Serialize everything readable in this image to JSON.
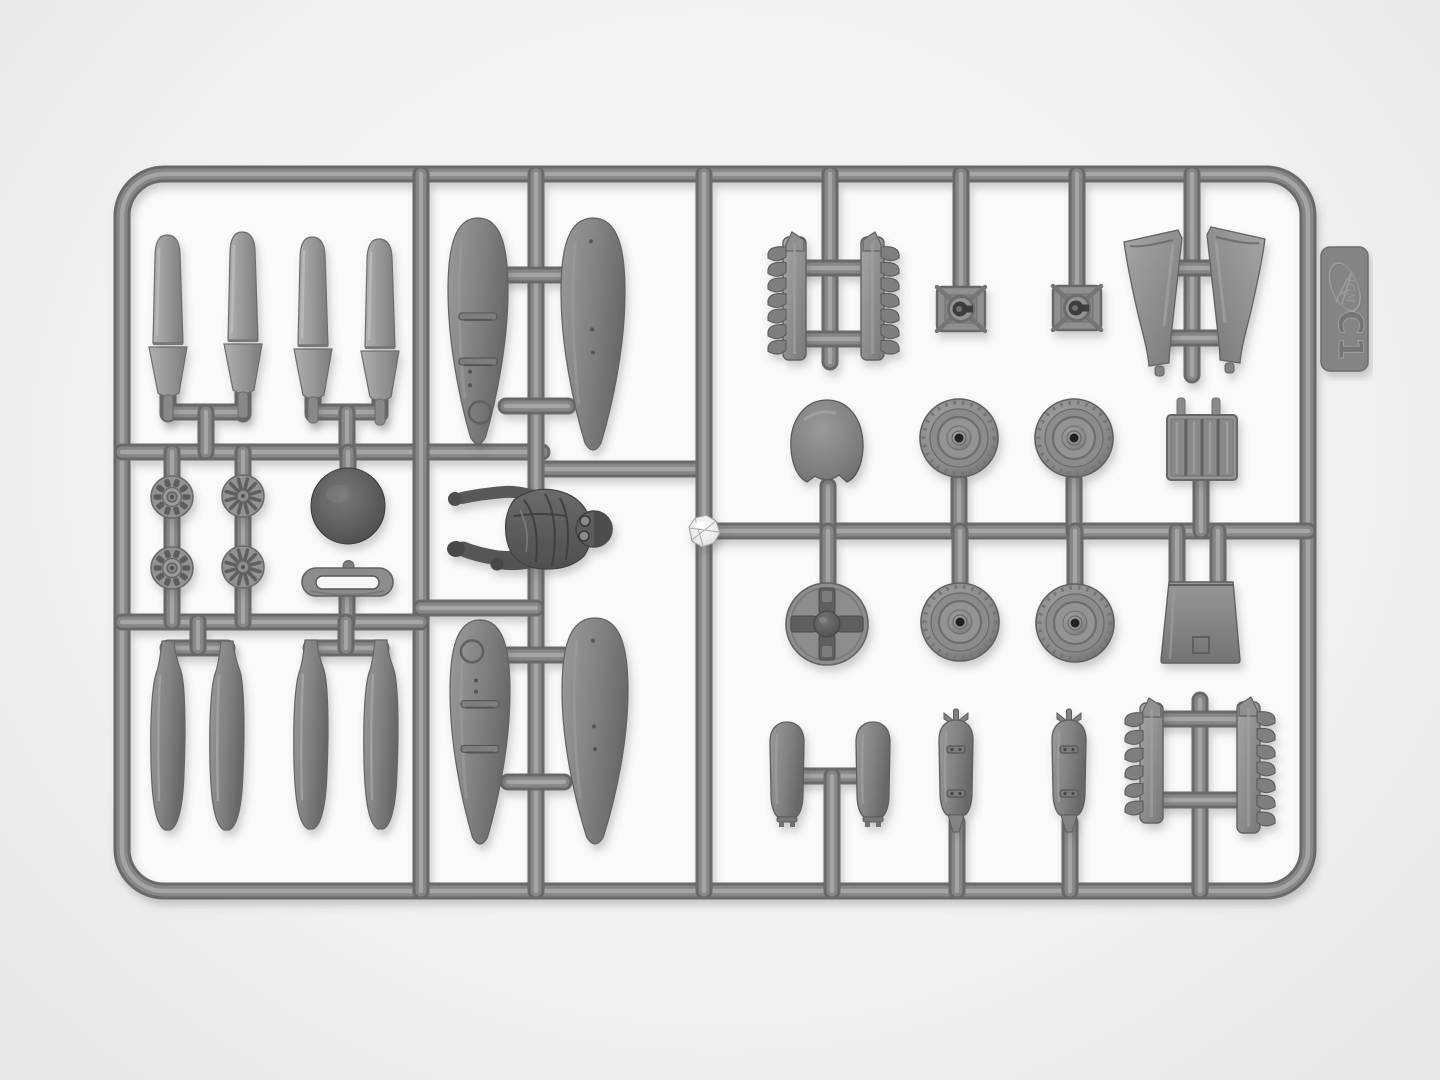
{
  "photo": {
    "description": "Top-down photo of a gray injection-molded model kit parts sprue on a white background",
    "background_color": "#f2f2f2",
    "interior_color": "#fafafa",
    "plastic_color": "#8a8a8a",
    "runner_color": "#6f6f6f"
  },
  "sprue": {
    "brand": "ICM",
    "code": "C1",
    "tab": {
      "x": 1321,
      "y": 247,
      "w": 47,
      "h": 124
    }
  },
  "frame": {
    "x1": 122,
    "y1": 174,
    "x2": 1308,
    "y2": 891,
    "radius": 42
  },
  "runners": [
    [
      122,
      452,
      542,
      452
    ],
    [
      536,
      469,
      704,
      469
    ],
    [
      421,
      174,
      421,
      891
    ],
    [
      536,
      174,
      536,
      891
    ],
    [
      704,
      174,
      704,
      891
    ],
    [
      421,
      608,
      536,
      608
    ],
    [
      122,
      622,
      421,
      622
    ],
    [
      704,
      531,
      1308,
      531
    ],
    [
      506,
      275,
      568,
      275
    ],
    [
      506,
      406,
      568,
      406
    ],
    [
      508,
      655,
      564,
      655
    ],
    [
      508,
      782,
      564,
      782
    ],
    [
      168,
      388,
      168,
      414
    ],
    [
      243,
      388,
      243,
      414
    ],
    [
      168,
      412,
      243,
      412
    ],
    [
      206,
      412,
      206,
      452
    ],
    [
      313,
      388,
      313,
      414
    ],
    [
      380,
      388,
      380,
      414
    ],
    [
      313,
      412,
      380,
      412
    ],
    [
      347,
      412,
      347,
      452
    ],
    [
      172,
      452,
      172,
      480
    ],
    [
      172,
      518,
      172,
      552
    ],
    [
      172,
      588,
      172,
      622
    ],
    [
      243,
      452,
      243,
      480
    ],
    [
      243,
      518,
      243,
      552
    ],
    [
      243,
      588,
      243,
      622
    ],
    [
      348,
      452,
      348,
      475
    ],
    [
      347,
      594,
      347,
      622
    ],
    [
      168,
      648,
      227,
      648
    ],
    [
      198,
      648,
      198,
      622
    ],
    [
      311,
      648,
      381,
      648
    ],
    [
      346,
      648,
      346,
      622
    ],
    [
      830,
      174,
      830,
      362
    ],
    [
      800,
      268,
      868,
      268
    ],
    [
      800,
      339,
      868,
      339
    ],
    [
      961,
      174,
      961,
      295
    ],
    [
      1077,
      174,
      1077,
      295
    ],
    [
      1192,
      174,
      1192,
      375
    ],
    [
      1160,
      268,
      1224,
      268
    ],
    [
      1160,
      338,
      1224,
      338
    ],
    [
      828,
      531,
      828,
      486
    ],
    [
      959,
      531,
      959,
      480
    ],
    [
      1074,
      531,
      1074,
      480
    ],
    [
      1201,
      531,
      1201,
      478
    ],
    [
      1177,
      531,
      1177,
      584
    ],
    [
      1218,
      531,
      1218,
      584
    ],
    [
      828,
      531,
      828,
      586
    ],
    [
      960,
      531,
      960,
      586
    ],
    [
      1075,
      531,
      1075,
      586
    ],
    [
      800,
      776,
      860,
      776
    ],
    [
      832,
      776,
      832,
      891
    ],
    [
      957,
      822,
      957,
      891
    ],
    [
      1070,
      822,
      1070,
      891
    ],
    [
      1200,
      700,
      1200,
      891
    ],
    [
      1158,
      719,
      1240,
      719
    ],
    [
      1158,
      800,
      1240,
      800
    ]
  ],
  "parts": [
    {
      "name": "propeller-blade-1",
      "type": "blade",
      "cx": 168,
      "top": 235
    },
    {
      "name": "propeller-blade-2",
      "type": "blade",
      "cx": 243,
      "top": 232
    },
    {
      "name": "propeller-blade-3",
      "type": "blade",
      "cx": 313,
      "top": 237
    },
    {
      "name": "propeller-blade-4",
      "type": "blade",
      "cx": 380,
      "top": 239
    },
    {
      "name": "float-half-top-outer",
      "type": "float",
      "cx": 478,
      "top": 218,
      "h": 226,
      "w": 60,
      "detail": "A"
    },
    {
      "name": "float-half-top-inner",
      "type": "float",
      "cx": 593,
      "top": 218,
      "h": 232,
      "w": 64,
      "detail": "plain"
    },
    {
      "name": "float-half-bottom-outer",
      "type": "float",
      "cx": 480,
      "top": 620,
      "h": 224,
      "w": 60,
      "detail": "B"
    },
    {
      "name": "float-half-bottom-inner",
      "type": "float",
      "cx": 595,
      "top": 618,
      "h": 226,
      "w": 66,
      "detail": "plain"
    },
    {
      "name": "engine-front-1",
      "type": "engine",
      "cx": 172,
      "cy": 497,
      "variant": "a"
    },
    {
      "name": "engine-front-2",
      "type": "engine",
      "cx": 172,
      "cy": 568,
      "variant": "a"
    },
    {
      "name": "engine-front-3",
      "type": "engine",
      "cx": 243,
      "cy": 496,
      "variant": "b"
    },
    {
      "name": "engine-front-4",
      "type": "engine",
      "cx": 243,
      "cy": 567,
      "variant": "b"
    },
    {
      "name": "spinner-dome",
      "type": "darkdome",
      "cx": 348,
      "cy": 506,
      "r": 37
    },
    {
      "name": "handle-loop",
      "type": "loop",
      "x": 302,
      "y": 568,
      "w": 91,
      "h": 28
    },
    {
      "name": "pilot-figure",
      "type": "pilot"
    },
    {
      "name": "shiny-sprue-gate",
      "type": "shiny",
      "cx": 704,
      "cy": 531
    },
    {
      "name": "exhaust-stack-top-left",
      "type": "exhaust",
      "x": 783,
      "top": 237,
      "h": 123,
      "n": 7,
      "dir": -1
    },
    {
      "name": "exhaust-stack-top-right",
      "type": "exhaust",
      "x": 861,
      "top": 237,
      "h": 123,
      "n": 7,
      "dir": 1
    },
    {
      "name": "mount-square-1",
      "type": "mount",
      "cx": 961,
      "cy": 309
    },
    {
      "name": "mount-square-2",
      "type": "mount",
      "cx": 1077,
      "cy": 308
    },
    {
      "name": "intake-scoop-left",
      "type": "funnel",
      "cx": 1153,
      "top": 230,
      "dir": -1
    },
    {
      "name": "intake-scoop-right",
      "type": "funnel",
      "cx": 1236,
      "top": 227,
      "dir": 1
    },
    {
      "name": "cowling-dome",
      "type": "cowl",
      "cx": 827,
      "cy": 441
    },
    {
      "name": "wheel-1",
      "type": "wheel",
      "cx": 959,
      "cy": 438
    },
    {
      "name": "wheel-2",
      "type": "wheel",
      "cx": 1074,
      "cy": 438
    },
    {
      "name": "wheel-3",
      "type": "wheel",
      "cx": 960,
      "cy": 622
    },
    {
      "name": "wheel-4",
      "type": "wheel",
      "cx": 1075,
      "cy": 623
    },
    {
      "name": "hub-cross-disc",
      "type": "crossdisc",
      "cx": 827,
      "cy": 624
    },
    {
      "name": "radiator-grille",
      "type": "grille",
      "x": 1167,
      "y": 415,
      "w": 70,
      "h": 65
    },
    {
      "name": "radiator-box",
      "type": "box",
      "x": 1166,
      "y": 582,
      "w": 70,
      "h": 81
    },
    {
      "name": "bomb-half-1",
      "type": "bombhalf",
      "cx": 787,
      "top": 722
    },
    {
      "name": "bomb-half-2",
      "type": "bombhalf",
      "cx": 873,
      "top": 722
    },
    {
      "name": "bomb-1",
      "type": "bomb",
      "cx": 956,
      "top": 720
    },
    {
      "name": "bomb-2",
      "type": "bomb",
      "cx": 1069,
      "top": 720
    },
    {
      "name": "exhaust-stack-bottom-left",
      "type": "exhaust",
      "x": 1140,
      "top": 703,
      "h": 120,
      "n": 6,
      "dir": -1
    },
    {
      "name": "exhaust-stack-bottom-right",
      "type": "exhaust",
      "x": 1237,
      "top": 702,
      "h": 131,
      "n": 7,
      "dir": 1
    },
    {
      "name": "tip-float-half-1",
      "type": "bottle",
      "cx": 168,
      "top": 641
    },
    {
      "name": "tip-float-half-2",
      "type": "bottle",
      "cx": 227,
      "top": 641
    },
    {
      "name": "tip-float-half-3",
      "type": "bottle",
      "cx": 311,
      "top": 640
    },
    {
      "name": "tip-float-half-4",
      "type": "bottle",
      "cx": 381,
      "top": 640
    }
  ]
}
